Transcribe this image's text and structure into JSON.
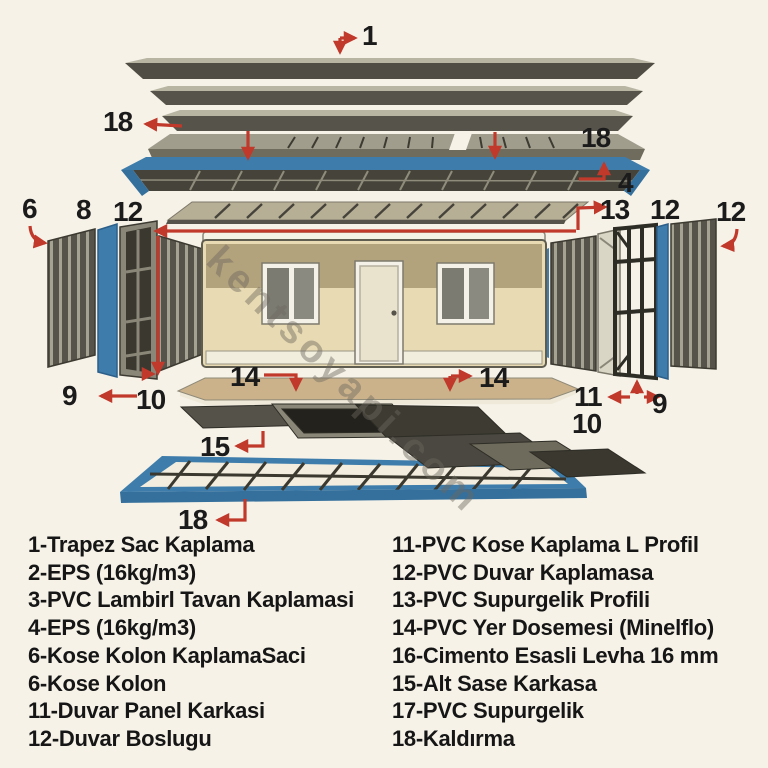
{
  "watermark": "kentsoyapi.com",
  "diagram": {
    "callouts": {
      "c1": "1",
      "c18_top_left": "18",
      "c18_top_right": "18",
      "c4": "4",
      "c13": "13",
      "c12_right_mid": "12",
      "c12_far_right": "12",
      "c6": "6",
      "c8": "8",
      "c12_left": "12",
      "c9_left": "9",
      "c10_left": "10",
      "c14_left": "14",
      "c14_right": "14",
      "c11_right": "11",
      "c10_right": "10",
      "c9_right": "9",
      "c15": "15",
      "c18_bottom": "18"
    },
    "colors": {
      "accent_blue": "#3e7dab",
      "arrow_red": "#c0392b",
      "panel_dark": "#56544a",
      "wall_band": "#b3a37c",
      "wall_beige": "#e8dab2",
      "floor_tan": "#cbb28b",
      "background": "#f6f2e8"
    }
  },
  "legend": {
    "left": [
      "1-Trapez Sac Kaplama",
      "2-EPS (16kg/m3)",
      "3-PVC Lambirl Tavan Kaplamasi",
      "4-EPS (16kg/m3)",
      "6-Kose Kolon KaplamaSaci",
      "6-Kose Kolon",
      "11-Duvar Panel Karkasi",
      "12-Duvar Boslugu"
    ],
    "right": [
      "11-PVC Kose Kaplama L Profil",
      "12-PVC Duvar Kaplamasa",
      "13-PVC Supurgelik Profili",
      "14-PVC Yer Dosemesi (Minelflo)",
      "16-Cimento Esasli Levha 16 mm",
      "15-Alt Sase Karkasa",
      "17-PVC Supurgelik",
      "18-Kaldırma"
    ]
  }
}
